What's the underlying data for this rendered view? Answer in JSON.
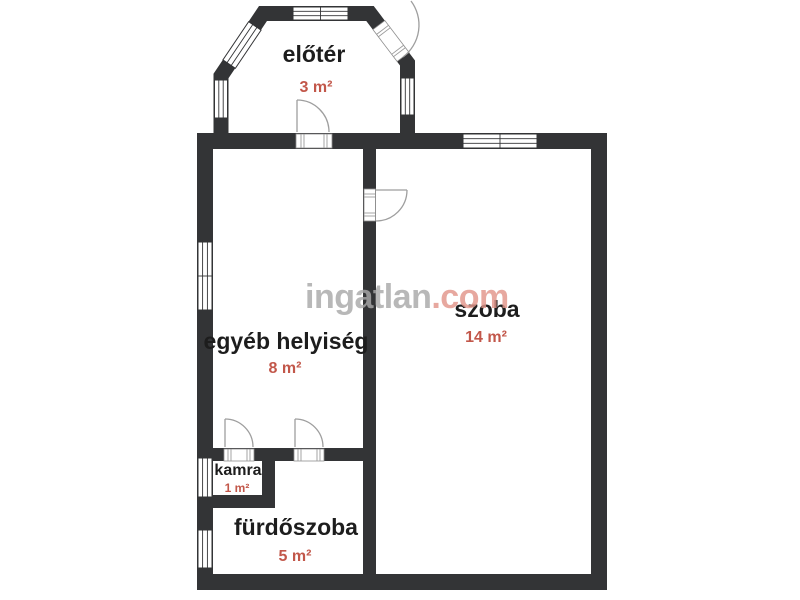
{
  "watermark": {
    "brand": "ingatlan",
    "tld": ".com"
  },
  "colors": {
    "wall": "#333436",
    "room_text": "#1d1d1d",
    "area_text": "#c2574a",
    "watermark_gray": "#a9a9a9",
    "watermark_red": "#e2968b"
  },
  "rooms": [
    {
      "id": "eloter",
      "name": "előtér",
      "area": "3 m²"
    },
    {
      "id": "egyeb-helyiseg",
      "name": "egyéb helyiség",
      "area": "8 m²"
    },
    {
      "id": "szoba",
      "name": "szoba",
      "area": "14 m²"
    },
    {
      "id": "kamra",
      "name": "kamra",
      "area": "1 m²"
    },
    {
      "id": "furdoszoba",
      "name": "fürdőszoba",
      "area": "5 m²"
    }
  ]
}
